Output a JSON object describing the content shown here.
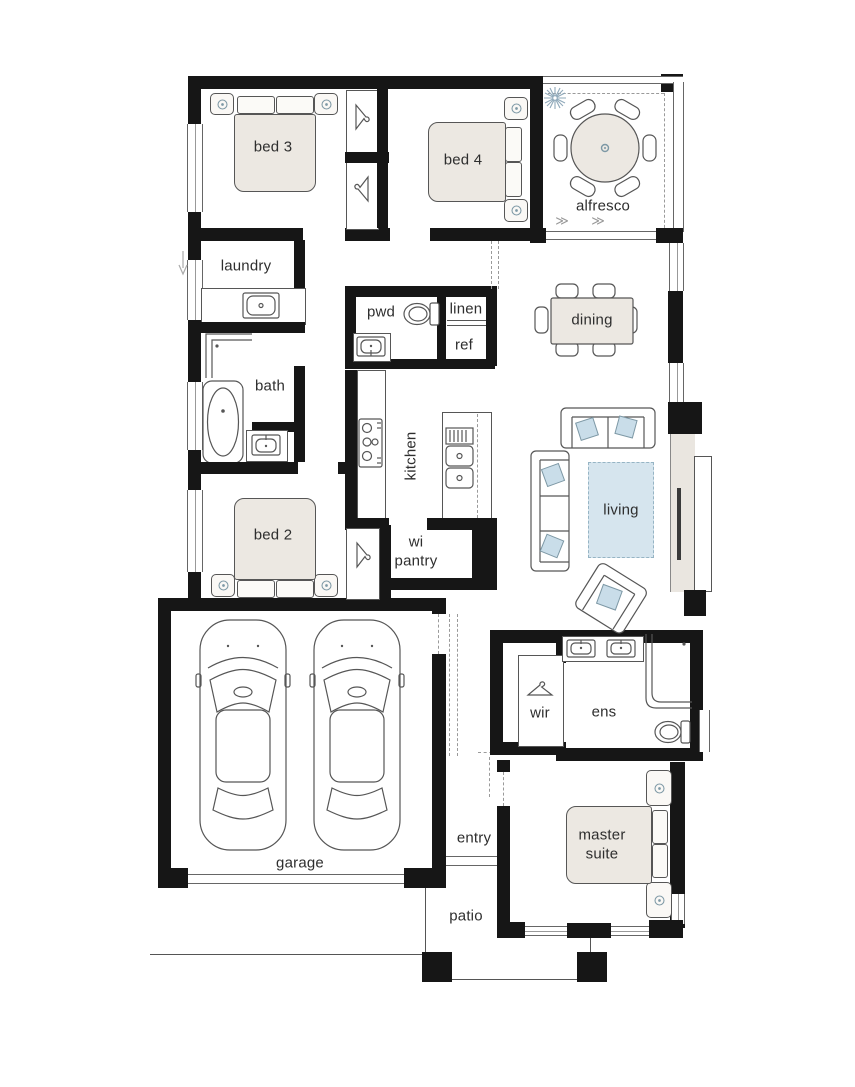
{
  "rooms": {
    "bed3": {
      "label": "bed 3"
    },
    "bed4": {
      "label": "bed 4"
    },
    "alfresco": {
      "label": "alfresco"
    },
    "laundry": {
      "label": "laundry"
    },
    "pwd": {
      "label": "pwd"
    },
    "linen": {
      "label": "linen"
    },
    "ref": {
      "label": "ref"
    },
    "dining": {
      "label": "dining"
    },
    "bath": {
      "label": "bath"
    },
    "kitchen": {
      "label": "kitchen"
    },
    "living": {
      "label": "living"
    },
    "bed2": {
      "label": "bed 2"
    },
    "wipantry": {
      "label": "wi pantry"
    },
    "wir": {
      "label": "wir"
    },
    "ens": {
      "label": "ens"
    },
    "entry": {
      "label": "entry"
    },
    "master": {
      "label": "master suite"
    },
    "garage": {
      "label": "garage"
    },
    "patio": {
      "label": "patio"
    }
  },
  "symbols": {
    "slide_arrow": "≫"
  },
  "colors": {
    "wall": "#161616",
    "line": "#565656",
    "furn": "#ece8e2",
    "blue": "#c9dde9",
    "rug": "#d6e5ee",
    "bluestroke": "#7d98a5"
  }
}
